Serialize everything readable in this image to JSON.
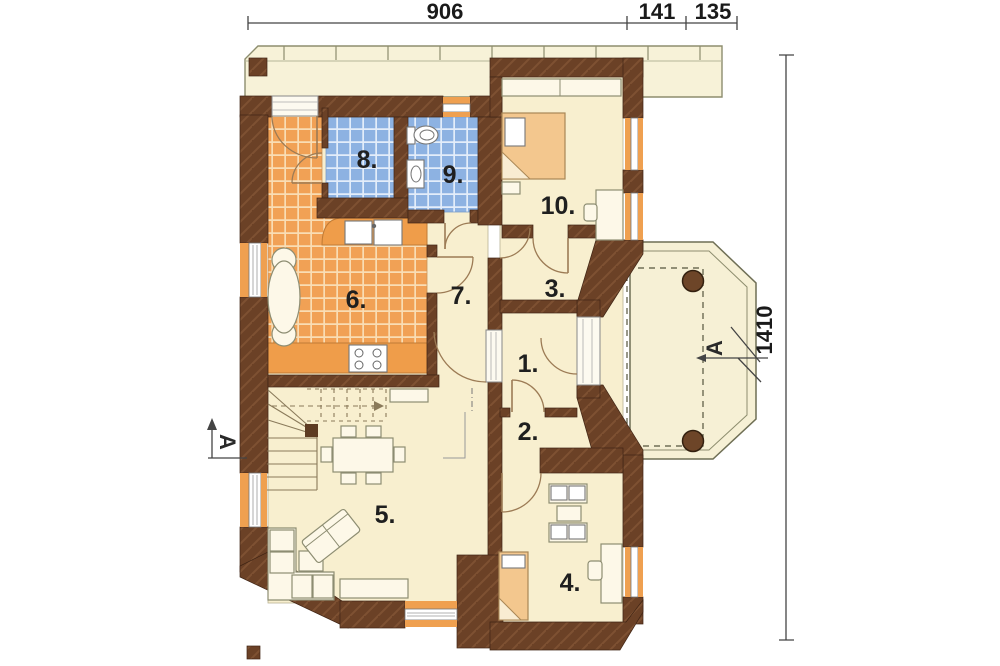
{
  "plan": {
    "type": "house-floor-plan"
  },
  "dimensions": {
    "top": [
      {
        "label": "906"
      },
      {
        "label": "141"
      },
      {
        "label": "135"
      }
    ],
    "right": [
      {
        "label": "1410"
      }
    ]
  },
  "rooms": [
    {
      "id": 1,
      "label": "1."
    },
    {
      "id": 2,
      "label": "2."
    },
    {
      "id": 3,
      "label": "3."
    },
    {
      "id": 4,
      "label": "4."
    },
    {
      "id": 5,
      "label": "5."
    },
    {
      "id": 6,
      "label": "6."
    },
    {
      "id": 7,
      "label": "7."
    },
    {
      "id": 8,
      "label": "8."
    },
    {
      "id": 9,
      "label": "9."
    },
    {
      "id": 10,
      "label": "10."
    }
  ],
  "section_markers": [
    {
      "side": "left",
      "label": "A"
    },
    {
      "side": "right",
      "label": "A"
    }
  ],
  "colors": {
    "wall": "#6b4126",
    "wall_hatch": "#7e5132",
    "floor_cream": "#f8efcf",
    "tile_orange": "#f1a155",
    "tile_orange_grout": "#f9ddb4",
    "tile_blue": "#8db2e2",
    "tile_blue_grout": "#e3edfa",
    "counter_orange": "#ef9d4a",
    "window_orange": "#efa050",
    "deck_cream": "#f7f2d8",
    "bed_tan": "#f3c78e"
  }
}
